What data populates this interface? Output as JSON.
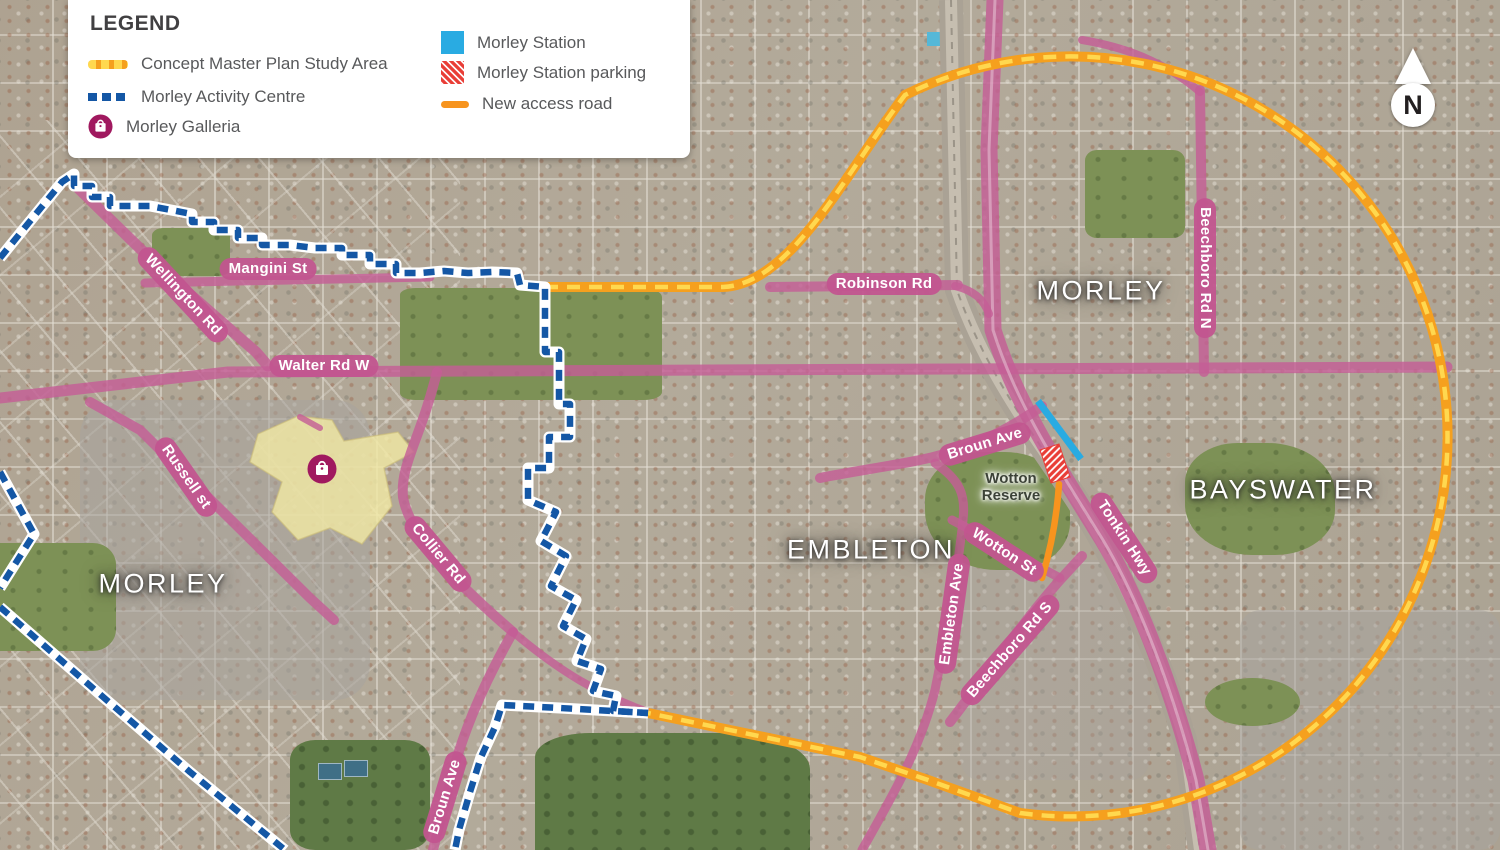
{
  "legend": {
    "title": "LEGEND",
    "items": [
      {
        "key": "study-area",
        "label": "Concept Master Plan Study Area",
        "swatch": "orange-yellow-dashed-line",
        "color": "#F5A01E",
        "dash_color": "#FFD84F"
      },
      {
        "key": "activity-centre",
        "label": "Morley Activity Centre",
        "swatch": "blue-dashed-line",
        "color": "#1457A5"
      },
      {
        "key": "galleria",
        "label": "Morley Galleria",
        "swatch": "shopping-bag-circle-icon",
        "color": "#A0195F"
      },
      {
        "key": "station",
        "label": "Morley Station",
        "swatch": "solid-square",
        "color": "#29ABE2"
      },
      {
        "key": "station-parking",
        "label": "Morley Station parking",
        "swatch": "hatched-square",
        "color": "#E93D36"
      },
      {
        "key": "access-road",
        "label": "New access road",
        "swatch": "solid-line",
        "color": "#F7941E"
      }
    ]
  },
  "map": {
    "suburbs": {
      "morley_left": "MORLEY",
      "morley_right": "MORLEY",
      "embleton": "EMBLETON",
      "bayswater": "BAYSWATER"
    },
    "places": {
      "wotton_reserve_line1": "Wotton",
      "wotton_reserve_line2": "Reserve"
    },
    "roads": {
      "mangini": "Mangini St",
      "wellington": "Wellington Rd",
      "walter": "Walter Rd W",
      "robinson": "Robinson Rd",
      "russell": "Russell st",
      "collier": "Collier Rd",
      "broun_station": "Broun Ave",
      "broun_south": "Broun Ave",
      "wotton_st": "Wotton St",
      "tonkin": "Tonkin Hwy",
      "beechboro_n": "Beechboro Rd N",
      "beechboro_s": "Beechboro Rd S",
      "embleton_ave": "Embleton Ave"
    },
    "compass": {
      "label": "N"
    },
    "colors": {
      "road_highlight": "#C45E96",
      "study_area_casing": "#F5A01E",
      "study_area_dash": "#FFD84F",
      "activity_centre": "#1457A5",
      "station": "#29ABE2",
      "station_parking": "#E93D36",
      "new_access_road": "#F7941E",
      "galleria": "#A0195F"
    }
  }
}
